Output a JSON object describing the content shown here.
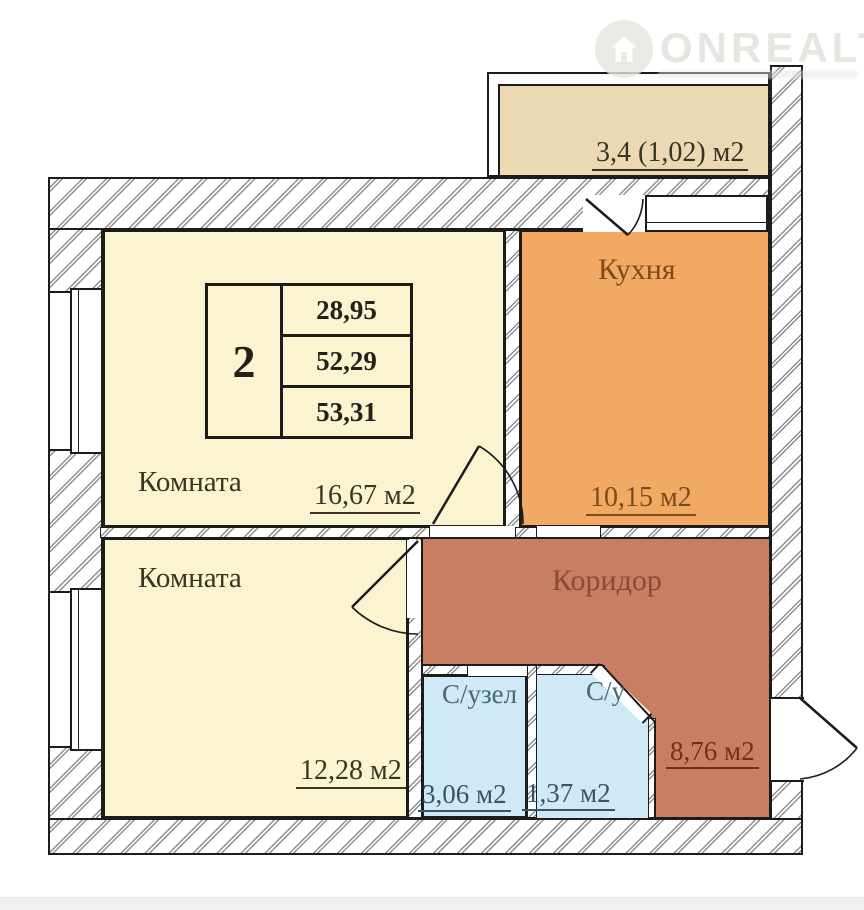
{
  "watermark": {
    "brand": "ONREALT",
    "icon": "house-in-circle"
  },
  "unit_table": {
    "room_count": "2",
    "values": [
      "28,95",
      "52,29",
      "53,31"
    ]
  },
  "rooms": {
    "balcony": {
      "area": "3,4 (1,02) м2"
    },
    "room1": {
      "label": "Комната",
      "area": "16,67 м2"
    },
    "kitchen": {
      "label": "Кухня",
      "area": "10,15 м2"
    },
    "room2": {
      "label": "Комната",
      "area": "12,28 м2"
    },
    "corridor": {
      "label": "Коридор",
      "area": "8,76 м2"
    },
    "bathroom": {
      "label": "С/узел",
      "area": "3,06 м2"
    },
    "wc": {
      "label": "С/у",
      "area": "1,37 м2"
    }
  },
  "colors": {
    "room-cream": "#faf5d0",
    "kitchen-orange": "#f2a963",
    "corridor-salmon": "#c97e63",
    "bath-blue": "#cfe9f6",
    "balcony-tan": "#ecd8b2",
    "wall-line": "#1c1c1c",
    "hatch-gray": "#8e8e8e",
    "text-dark": "#3b3425",
    "text-table": "#23211a",
    "text-kitchen": "#7c4a1c",
    "text-corridor": "#8b4a35",
    "text-corridor-area": "#7a2c18",
    "text-bath": "#46697c",
    "text-bath-area": "#35566a",
    "watermark-gray": "#e7e4e0"
  }
}
